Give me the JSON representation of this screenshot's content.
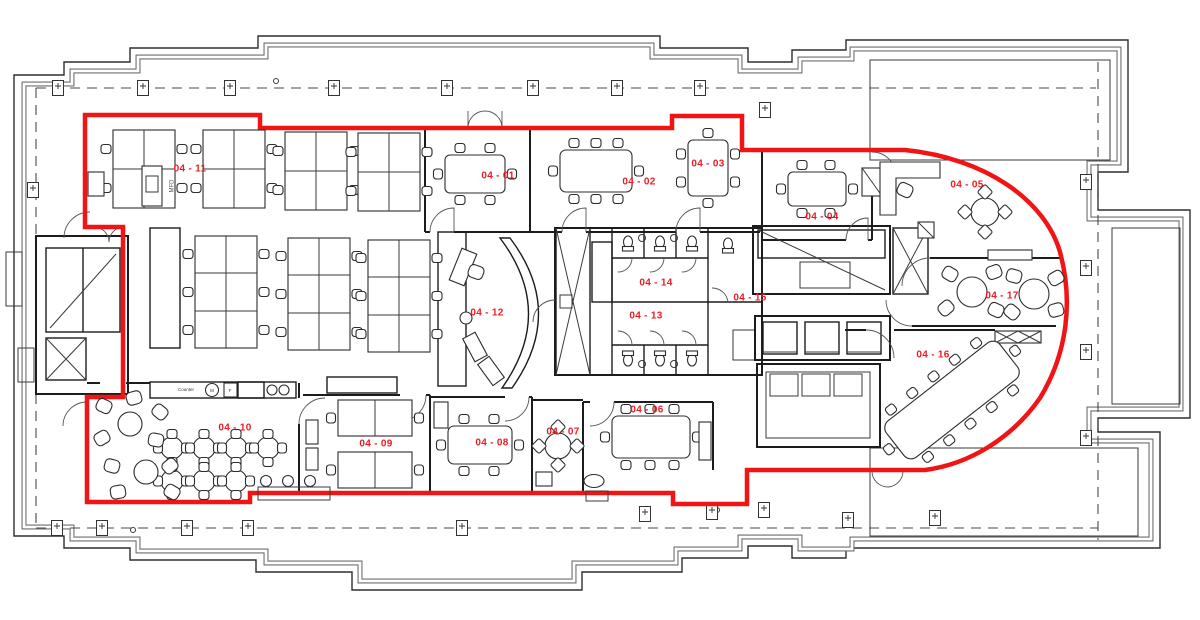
{
  "document": {
    "type": "architectural floor plan",
    "description": "Office level 04 fit-out plan with red demise boundary"
  },
  "colors": {
    "demise_boundary": "#f01414",
    "room_label": "#ed1c24",
    "walls": "#1c1c1c",
    "shell": "#2e2e2e",
    "background": "#ffffff"
  },
  "rooms": [
    {
      "id": "04-01",
      "label": "04 - 01"
    },
    {
      "id": "04-02",
      "label": "04 - 02"
    },
    {
      "id": "04-03",
      "label": "04 - 03"
    },
    {
      "id": "04-04",
      "label": "04 - 04"
    },
    {
      "id": "04-05",
      "label": "04 - 05"
    },
    {
      "id": "04-06",
      "label": "04 - 06"
    },
    {
      "id": "04-07",
      "label": "04 - 07"
    },
    {
      "id": "04-08",
      "label": "04 - 08"
    },
    {
      "id": "04-09",
      "label": "04 - 09"
    },
    {
      "id": "04-10",
      "label": "04 - 10"
    },
    {
      "id": "04-11",
      "label": "04 - 11"
    },
    {
      "id": "04-12",
      "label": "04 - 12"
    },
    {
      "id": "04-13",
      "label": "04 - 13"
    },
    {
      "id": "04-14",
      "label": "04 - 14"
    },
    {
      "id": "04-15",
      "label": "04 - 15"
    },
    {
      "id": "04-16",
      "label": "04 - 16"
    },
    {
      "id": "04-17",
      "label": "04 - 17"
    }
  ],
  "annotations": {
    "mfd": "MFD",
    "counter": "Counter",
    "microwave": "M",
    "fridge": "F"
  }
}
